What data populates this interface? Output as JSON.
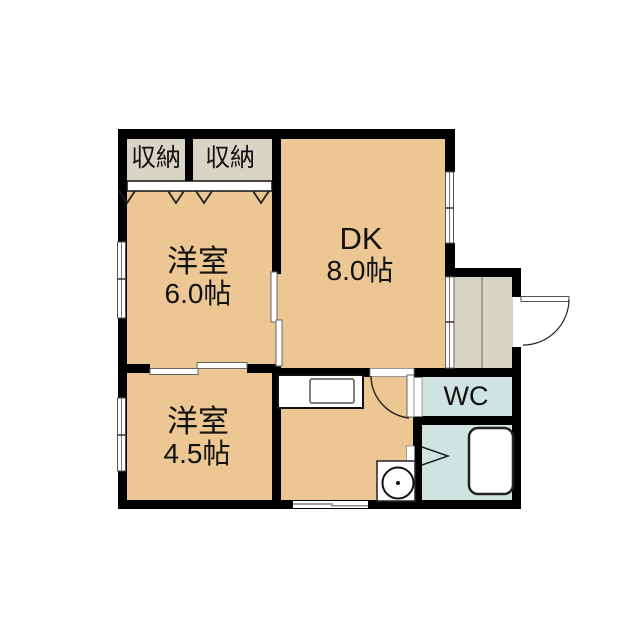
{
  "plan": {
    "type_note": "apartment floor plan",
    "rooms": {
      "closet_left": {
        "label": "収納"
      },
      "closet_right": {
        "label": "収納"
      },
      "western_6": {
        "label": "洋室",
        "size": "6.0帖"
      },
      "dk": {
        "label": "DK",
        "size": "8.0帖"
      },
      "western_45": {
        "label": "洋室",
        "size": "4.5帖"
      },
      "wc": {
        "label": "WC"
      }
    },
    "colors": {
      "room_floor": "#ecc793",
      "closet_entry_floor": "#d8d4c6",
      "wet_area_floor": "#cfe3e0",
      "wall": "#000000",
      "background": "#ffffff"
    }
  }
}
